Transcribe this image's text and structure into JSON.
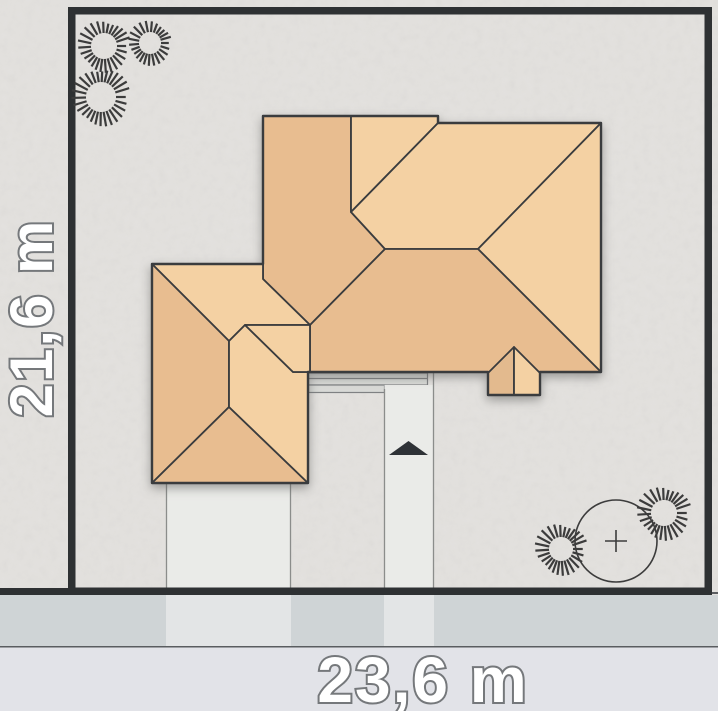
{
  "dimensions": {
    "plot_width_label": "23,6 m",
    "plot_height_label": "21,6 m"
  },
  "colors": {
    "background": "#e3e1de",
    "sidewalk_band": "#cfd4d6",
    "crossing": "#e3e5e6",
    "road_band": "#e2e3e8",
    "road_line": "#5a5d60",
    "plot_border": "#2e3133",
    "roof_light": "#f4d1a3",
    "roof_dark": "#e8bd90",
    "roof_gable_left": "#e3ba8e",
    "roof_line": "#3a3c3e",
    "path_fill": "#eaebe8",
    "path_line": "#8b8d8b",
    "terrace_fill": "#d8d9d6",
    "terrace_line": "#7f8183",
    "arrow": "#2e3236",
    "tree_line": "#3c3c3c",
    "label_fill": "#ffffff",
    "label_stroke": "#75787b"
  },
  "geometry": {
    "canvas": {
      "w": 718,
      "h": 711
    },
    "ground": {
      "x": 0,
      "y": 0,
      "w": 718,
      "h": 595
    },
    "sidewalk": {
      "x": 0,
      "y": 595,
      "w": 718,
      "h": 51
    },
    "road": {
      "x": 0,
      "y": 646,
      "w": 718,
      "h": 65
    },
    "crossings": [
      {
        "x": 166,
        "y": 595,
        "w": 125,
        "h": 51
      },
      {
        "x": 384,
        "y": 595,
        "w": 50,
        "h": 51
      }
    ],
    "plot_border": {
      "x": 71.75,
      "y": 10.75,
      "w": 636.5,
      "h": 580.5,
      "stroke_w": 7.5
    },
    "boundary_line": {
      "x1": 0,
      "y1": 591.5,
      "x2": 712,
      "y2": 591.5,
      "w": 7
    },
    "boundary_line_ext": {
      "x1": 712,
      "y1": 593,
      "x2": 718,
      "y2": 593,
      "w": 2
    },
    "driveway": {
      "x": 166,
      "y": 483,
      "w": 125,
      "h": 112
    },
    "walkway": {
      "x": 384.5,
      "y": 385,
      "w": 49,
      "h": 210,
      "left_line": [
        384.5,
        389,
        384.5,
        595
      ],
      "right_line": [
        433.5,
        373,
        433.5,
        595
      ]
    },
    "terrace": [
      {
        "x": 308.5,
        "y": 373,
        "w": 119,
        "h": 12
      },
      {
        "x": 308.5,
        "y": 385,
        "w": 76,
        "h": 7.5
      }
    ],
    "terrace_inner_line": [
      308.5,
      378.5,
      427.5,
      378.5
    ],
    "arrow_points": "389,455 428,455 408.5,441",
    "roof_outline": "263,116 438,116 438,123 601,123 601,372 540,372 540,395 488,395 488,372 308,372 308,483 152,483 152,264 263,264",
    "roof_planes": [
      {
        "shade": "dark",
        "pts": "263,116 351,116 351,212 385,249 310,325 263,279 263,264"
      },
      {
        "shade": "light",
        "pts": "351,116 438,116 438,123 351,212"
      },
      {
        "shade": "light",
        "pts": "438,123 601,123 478,249 385,249 351,212"
      },
      {
        "shade": "light",
        "pts": "601,123 601,372 478,249"
      },
      {
        "shade": "dark",
        "pts": "385,249 478,249 601,372 310,372 310,325"
      },
      {
        "shade": "light",
        "pts": "152,264 263,264 263,279 310,325 245,325 229,341"
      },
      {
        "shade": "dark",
        "pts": "152,264 229,341 229,407 152,483"
      },
      {
        "shade": "dark",
        "pts": "152,483 229,407 308,483"
      },
      {
        "shade": "light",
        "pts": "229,341 245,325 293,372 308,372 308,483 229,407"
      },
      {
        "shade": "light",
        "pts": "245,325 310,325 310,372 293,372"
      },
      {
        "shade": "gable_left",
        "pts": "488,395 488,373 514,347 514,395"
      },
      {
        "shade": "light",
        "pts": "514,395 514,347 540,373 540,395"
      }
    ],
    "shrubs": [
      {
        "cx": 104,
        "cy": 46,
        "r1": 13,
        "r2": 27,
        "n": 26
      },
      {
        "cx": 150,
        "cy": 43,
        "r1": 11,
        "r2": 23,
        "n": 24
      },
      {
        "cx": 101,
        "cy": 97,
        "r1": 15,
        "r2": 30,
        "n": 28
      },
      {
        "cx": 561,
        "cy": 549,
        "r1": 12,
        "r2": 27,
        "n": 26
      },
      {
        "cx": 664,
        "cy": 513,
        "r1": 13,
        "r2": 28,
        "n": 26
      }
    ],
    "tree": {
      "cx": 616,
      "cy": 541,
      "r": 41,
      "cross": 11
    },
    "width_label_pos": {
      "x": 423,
      "y": 702,
      "size": 64
    },
    "height_label_pos": {
      "x": 31,
      "y": 318,
      "size": 60,
      "rotate": -90
    }
  }
}
